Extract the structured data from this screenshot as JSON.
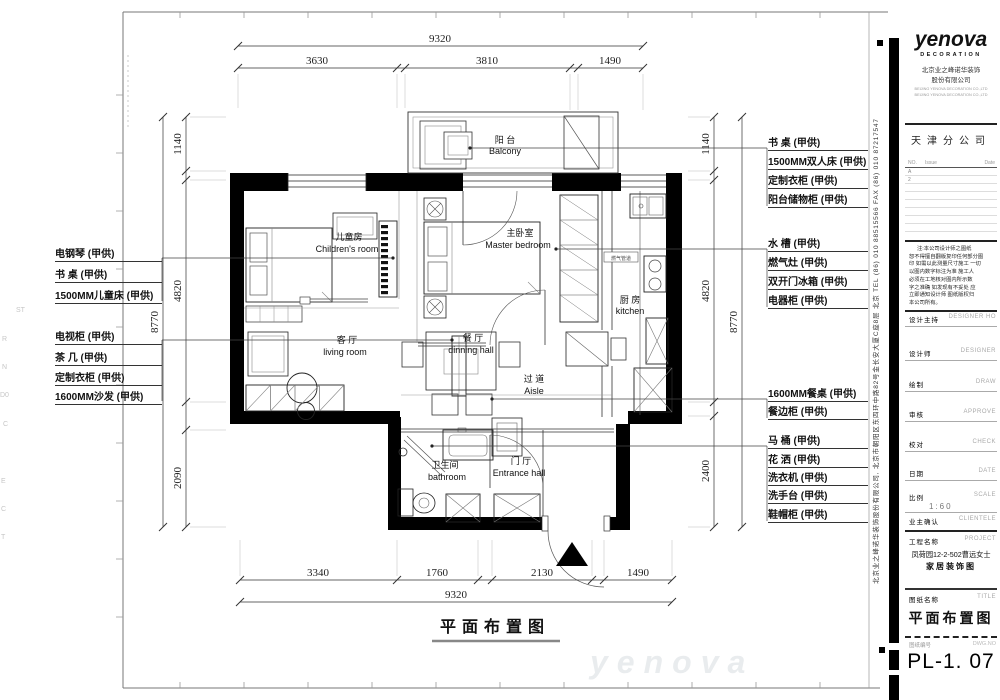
{
  "sheet": {
    "plan_title": "平面布置图",
    "watermark": "yenova",
    "margin_chars": [
      "ST",
      "R",
      "N",
      "D0",
      "C",
      "E",
      "C",
      "T"
    ]
  },
  "dims": {
    "top_total": "9320",
    "top_seg_1": "3630",
    "top_seg_2": "3810",
    "top_seg_3": "1490",
    "bottom_seg_1": "3340",
    "bottom_seg_2": "1760",
    "bottom_seg_3": "2130",
    "bottom_seg_4": "1490",
    "bottom_total": "9320",
    "left_outer": "8770",
    "left_seg_1": "1140",
    "left_seg_2": "4820",
    "left_seg_3": "2090",
    "right_outer": "8770",
    "right_seg_1": "1140",
    "right_seg_2": "4820",
    "right_seg_3": "2400"
  },
  "rooms": {
    "balcony_cn": "阳 台",
    "balcony_en": "Balcony",
    "children_cn": "儿童房",
    "children_en": "Children's room",
    "master_cn": "主卧室",
    "master_en": "Master bedroom",
    "kitchen_cn": "厨 房",
    "kitchen_en": "kitchen",
    "living_cn": "客 厅",
    "living_en": "living room",
    "dining_cn": "餐 厅",
    "dining_en": "dinning hall",
    "aisle_cn": "过 道",
    "aisle_en": "Aisle",
    "bath_cn": "卫生间",
    "bath_en": "bathroom",
    "entrance_cn": "门 厅",
    "entrance_en": "Entrance hall",
    "gas_label": "燃气管道"
  },
  "left_labels": [
    "电钢琴 (甲供)",
    "书 桌 (甲供)",
    "1500MM儿童床 (甲供)",
    "电视柜 (甲供)",
    "茶 几 (甲供)",
    "定制衣柜 (甲供)",
    "1600MM沙发 (甲供)"
  ],
  "right_labels": [
    "书 桌 (甲供)",
    "1500MM双人床 (甲供)",
    "定制衣柜 (甲供)",
    "阳台储物柜 (甲供)",
    "水 槽 (甲供)",
    "燃气灶 (甲供)",
    "双开门冰箱 (甲供)",
    "电器柜 (甲供)",
    "1600MM餐桌 (甲供)",
    "餐边柜 (甲供)",
    "马 桶 (甲供)",
    "花 洒 (甲供)",
    "洗衣机 (甲供)",
    "洗手台 (甲供)",
    "鞋帽柜 (甲供)"
  ],
  "title_block": {
    "logo": "yenova",
    "logo_sub": "DECORATION",
    "company_cn_1": "北京业之峰诺华装饰",
    "company_cn_2": "股份有限公司",
    "company_en_1": "BEIJING YENOVA DECORATION CO.,LTD",
    "company_en_2": "BEIJING YENOVA DECORATION CO.,LTD",
    "branch": "天津分公司",
    "revision": {
      "no_label": "NO.",
      "issue_label": "Issue",
      "date_label": "Date",
      "rows": [
        "A",
        "2"
      ]
    },
    "disclaimer": [
      "注:本公司设计师之图纸",
      "恕不得擅自翻版复印任何部分图",
      "印 如需以此测量尺寸施工 一切",
      "以图内数字标注为准 施工人",
      "必须在工地核对图内所示数",
      "字之准确 如发现有不妥处 应",
      "立即通知设计师 图纸版权归",
      "本公司所有。"
    ],
    "fields": [
      {
        "cn": "设计主持",
        "en": "DESIGNER HO"
      },
      {
        "cn": "设计师",
        "en": "DESIGNER"
      },
      {
        "cn": "绘制",
        "en": "DRAW"
      },
      {
        "cn": "审核",
        "en": "APPROVE"
      },
      {
        "cn": "校对",
        "en": "CHECK"
      },
      {
        "cn": "日期",
        "en": "DATE"
      }
    ],
    "scale": {
      "cn": "比例",
      "en": "SCALE",
      "value": "1:60"
    },
    "client": {
      "cn": "业主确认",
      "en": "CLIENTELE"
    },
    "project": {
      "cn": "工程名称",
      "en": "PROJECT",
      "line1": "凤荷园12-2-502曹远女士",
      "line2": "家居装饰图"
    },
    "sheet_name": {
      "cn": "图纸名称",
      "en": "TITLE",
      "value": "平面布置图"
    },
    "number": {
      "cn": "图纸编号",
      "en": "DWG.NO",
      "value": "PL-1. 07"
    },
    "side_text": "北京业之峰诺华装饰股份有限公司, 北京市朝阳区东四环中路82号金长安大厦C座8层  北京  TEL (86) 010 88515566  FAX (86) 010 87217547"
  }
}
